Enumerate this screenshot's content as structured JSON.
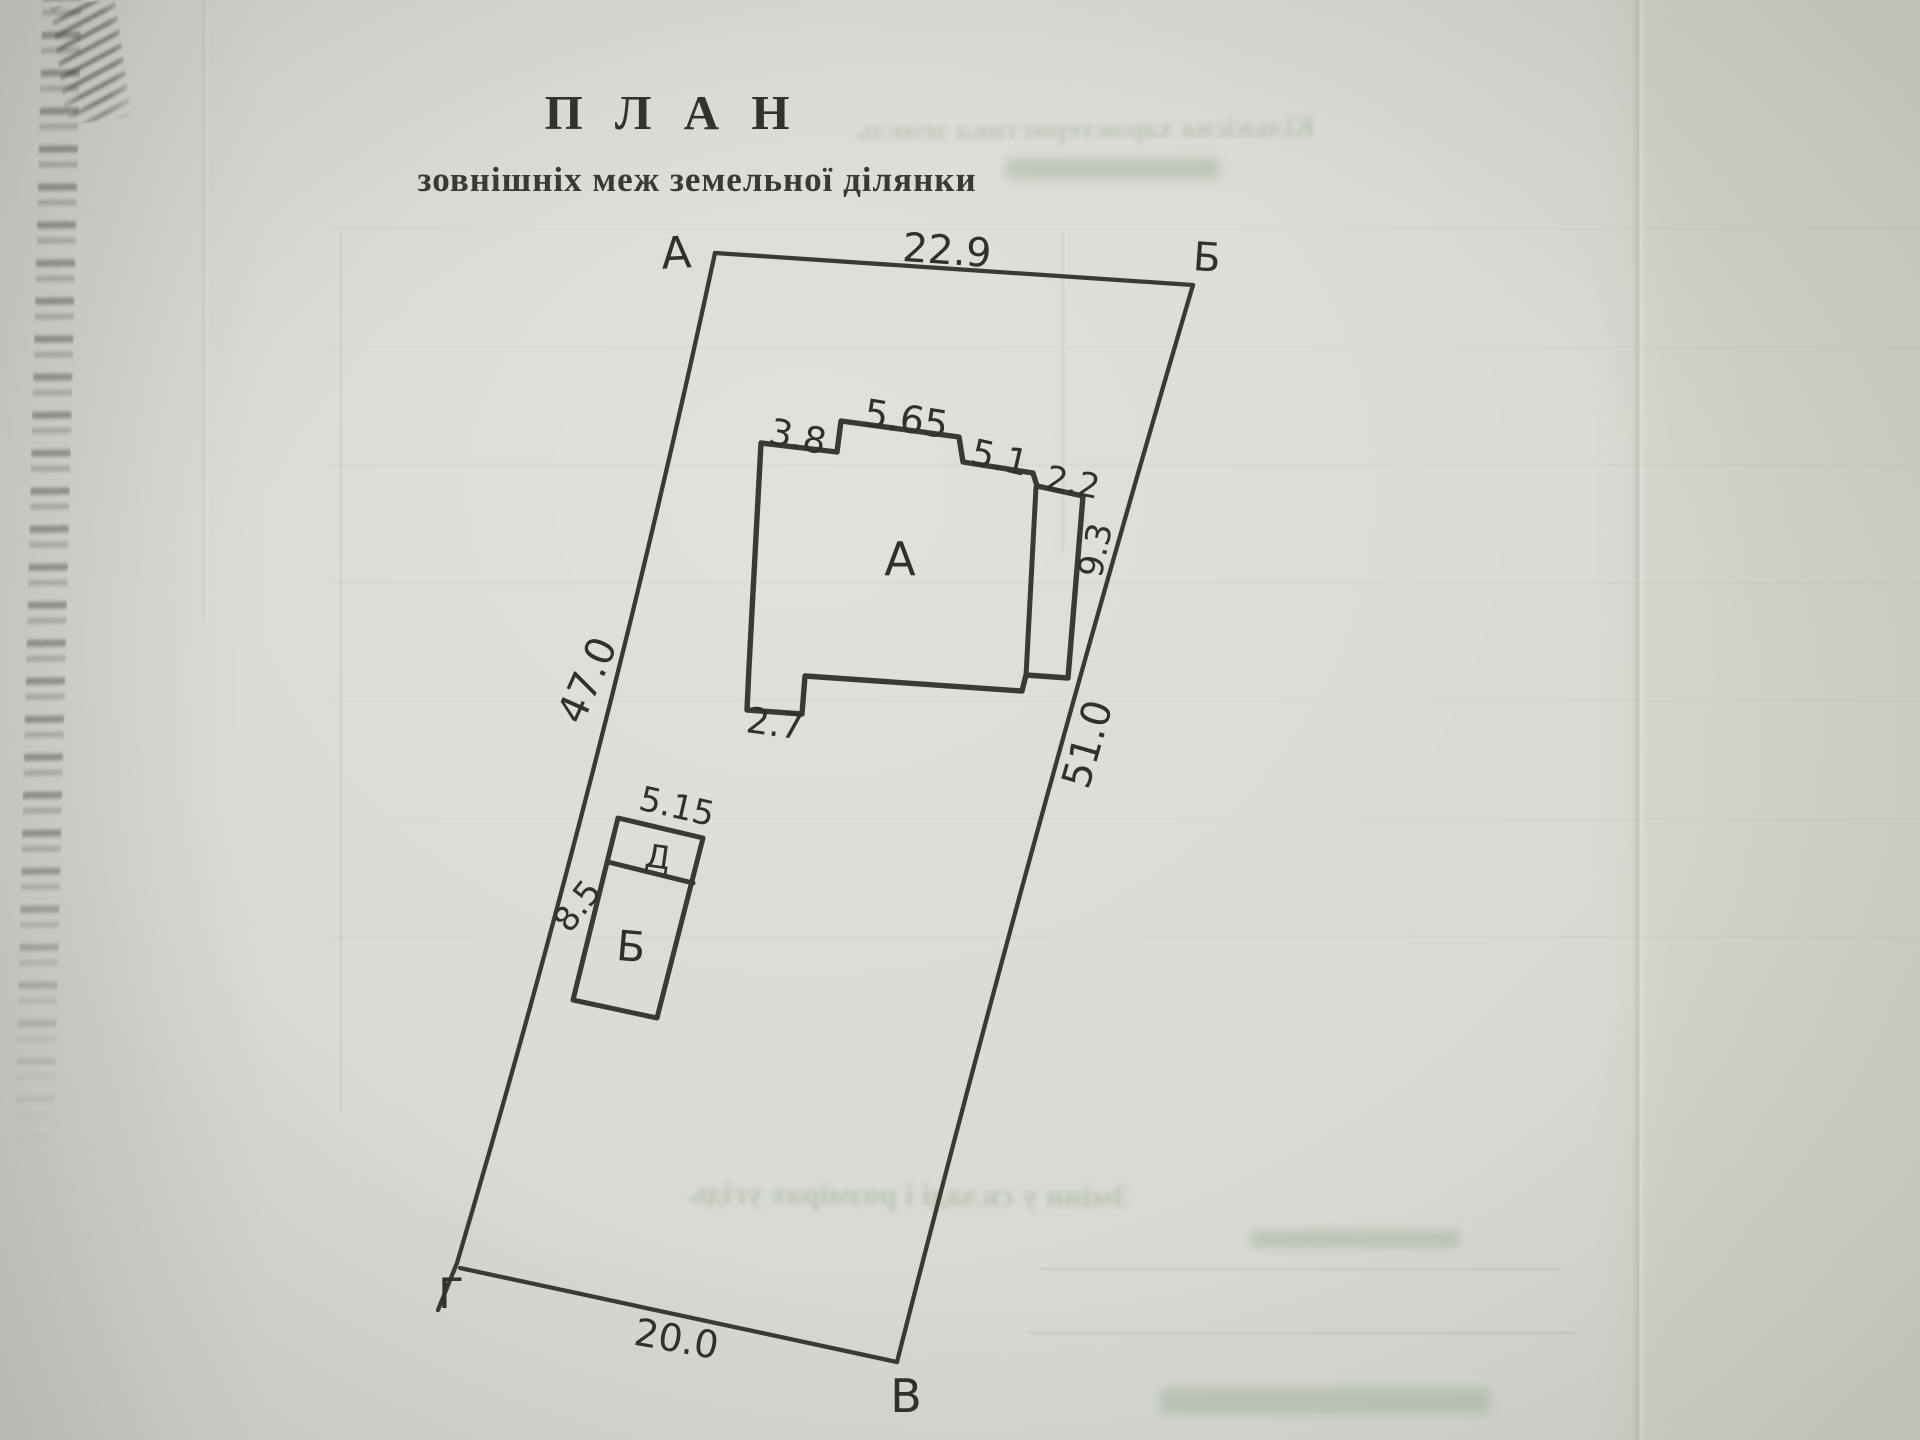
{
  "title": {
    "main": "П Л А Н",
    "subtitle": "зовнішніх меж земельної ділянки"
  },
  "plan": {
    "corners": {
      "top_left": "А",
      "top_right": "Б",
      "bottom_right": "В",
      "bottom_left": "Г"
    },
    "sides": {
      "top": "22.9",
      "right": "51.0",
      "bottom": "20.0",
      "left": "47.0"
    },
    "building_a": {
      "label": "А",
      "top_left_width": "3.8",
      "top_middle_width": "5.65",
      "top_right_width": "5.1",
      "wing_width": "2.2",
      "wing_depth": "9.3",
      "porch_width": "2.7"
    },
    "building_bd": {
      "label_main": "Б",
      "label_upper": "Д",
      "width": "5.15",
      "side_length": "8.5"
    }
  },
  "bleed_through": {
    "top_line": "Кількісна характеристика земель",
    "middle_line": "Зміни у складі і розмірах угідь"
  },
  "colors": {
    "paper": "#d7dad2",
    "ink": "#34342e",
    "bleed": "#86947e"
  }
}
